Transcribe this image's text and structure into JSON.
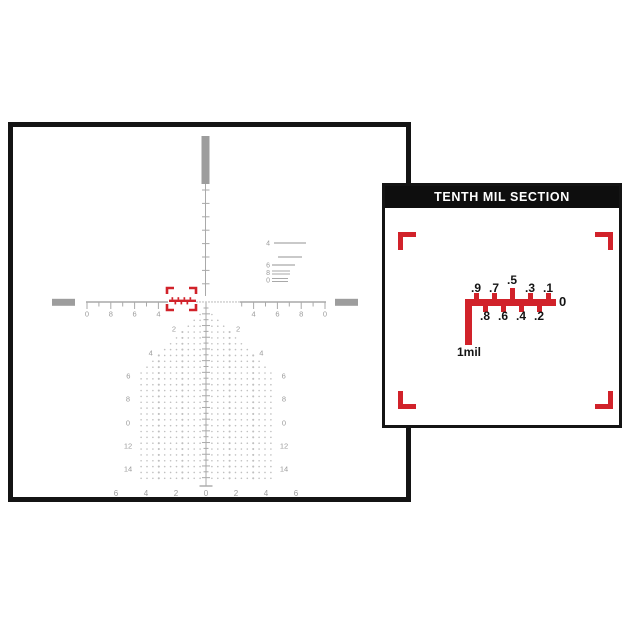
{
  "colors": {
    "red": "#d1222a",
    "black": "#141414",
    "bar_gray": "#9d9d9d",
    "line_gray": "#a9a9a9",
    "dot_gray": "#c0c0c0",
    "label_gray": "#9b9b9b",
    "light_gray": "#c6c6c6"
  },
  "detail_panel": {
    "title": "TENTH MIL SECTION",
    "top_labels": [
      ".9",
      ".7",
      ".5",
      ".3",
      ".1"
    ],
    "bottom_labels": [
      ".8",
      ".6",
      ".4",
      ".2"
    ],
    "zero_label": "0",
    "mil_label": "1mil"
  },
  "reticle": {
    "horizontal_left_labels": [
      "0",
      "8",
      "6",
      "4"
    ],
    "horizontal_right_labels": [
      "4",
      "6",
      "8",
      "0"
    ],
    "drop_labels": [
      "2",
      "4",
      "6",
      "8",
      "0",
      "12",
      "14"
    ],
    "bottom_labels": [
      "6",
      "4",
      "2",
      "0",
      "2",
      "4",
      "6"
    ],
    "ranging_labels": [
      "4",
      "",
      "6",
      "8",
      "0"
    ]
  }
}
